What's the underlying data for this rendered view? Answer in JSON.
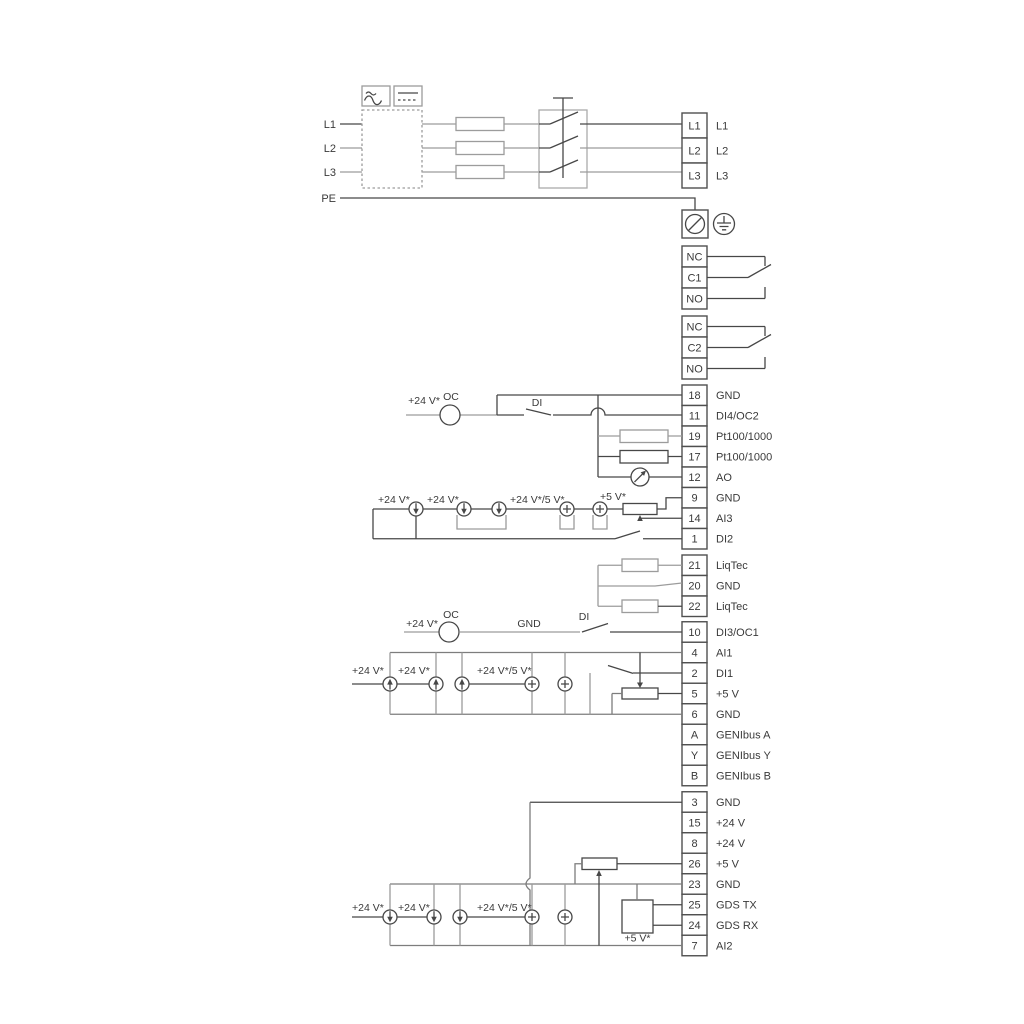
{
  "labels": {
    "v24": "+24 V*",
    "v24_5": "+24 V*/5 V*",
    "v5": "+5 V*",
    "oc": "OC",
    "di": "DI",
    "gnd": "GND"
  },
  "power": {
    "inputs": [
      "L1",
      "L2",
      "L3",
      "PE"
    ],
    "outputs": [
      {
        "id": "L1",
        "label": "L1"
      },
      {
        "id": "L2",
        "label": "L2"
      },
      {
        "id": "L3",
        "label": "L3"
      }
    ]
  },
  "relays": {
    "r1": [
      {
        "id": "NC"
      },
      {
        "id": "C1"
      },
      {
        "id": "NO"
      }
    ],
    "r2": [
      {
        "id": "NC"
      },
      {
        "id": "C2"
      },
      {
        "id": "NO"
      }
    ]
  },
  "terminals": {
    "g1": [
      {
        "id": "18",
        "label": "GND"
      },
      {
        "id": "11",
        "label": "DI4/OC2"
      },
      {
        "id": "19",
        "label": "Pt100/1000"
      },
      {
        "id": "17",
        "label": "Pt100/1000"
      },
      {
        "id": "12",
        "label": "AO"
      },
      {
        "id": "9",
        "label": "GND"
      },
      {
        "id": "14",
        "label": "AI3"
      },
      {
        "id": "1",
        "label": "DI2"
      }
    ],
    "g2": [
      {
        "id": "21",
        "label": "LiqTec"
      },
      {
        "id": "20",
        "label": "GND"
      },
      {
        "id": "22",
        "label": "LiqTec"
      }
    ],
    "g3": [
      {
        "id": "10",
        "label": "DI3/OC1"
      },
      {
        "id": "4",
        "label": "AI1"
      },
      {
        "id": "2",
        "label": "DI1"
      },
      {
        "id": "5",
        "label": "+5 V"
      },
      {
        "id": "6",
        "label": "GND"
      },
      {
        "id": "A",
        "label": "GENIbus A"
      },
      {
        "id": "Y",
        "label": "GENIbus Y"
      },
      {
        "id": "B",
        "label": "GENIbus B"
      }
    ],
    "g4": [
      {
        "id": "3",
        "label": "GND"
      },
      {
        "id": "15",
        "label": "+24 V"
      },
      {
        "id": "8",
        "label": "+24 V"
      },
      {
        "id": "26",
        "label": "+5 V"
      },
      {
        "id": "23",
        "label": "GND"
      },
      {
        "id": "25",
        "label": "GDS TX"
      },
      {
        "id": "24",
        "label": "GDS RX"
      },
      {
        "id": "7",
        "label": "AI2"
      }
    ]
  },
  "colors": {
    "line_dark": "#474747",
    "line_grey": "#9c9c9c",
    "text": "#3a3a3a"
  }
}
